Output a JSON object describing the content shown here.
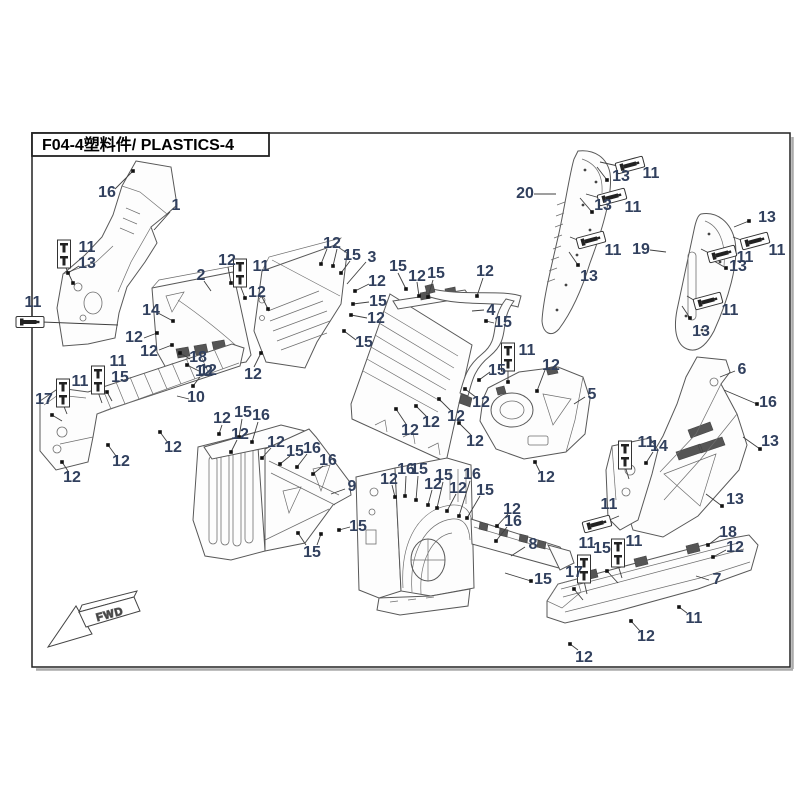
{
  "title": "F04-4塑料件/ PLASTICS-4",
  "fwd_label": "FWD",
  "colors": {
    "label": "#31405e",
    "leader": "#3f3f3f",
    "frame": "#1f1f1f"
  },
  "callouts": [
    {
      "t": "16",
      "x": 107,
      "y": 192
    },
    {
      "t": "1",
      "x": 176,
      "y": 205
    },
    {
      "t": "11",
      "x": 87,
      "y": 247
    },
    {
      "t": "13",
      "x": 87,
      "y": 263
    },
    {
      "t": "11",
      "x": 33,
      "y": 302
    },
    {
      "t": "14",
      "x": 151,
      "y": 310
    },
    {
      "t": "2",
      "x": 201,
      "y": 275
    },
    {
      "t": "12",
      "x": 227,
      "y": 260
    },
    {
      "t": "11",
      "x": 261,
      "y": 266
    },
    {
      "t": "12",
      "x": 134,
      "y": 337
    },
    {
      "t": "12",
      "x": 149,
      "y": 351
    },
    {
      "t": "18",
      "x": 198,
      "y": 357
    },
    {
      "t": "12",
      "x": 208,
      "y": 370
    },
    {
      "t": "12",
      "x": 253,
      "y": 374
    },
    {
      "t": "12",
      "x": 257,
      "y": 292
    },
    {
      "t": "12",
      "x": 332,
      "y": 243
    },
    {
      "t": "15",
      "x": 352,
      "y": 255
    },
    {
      "t": "3",
      "x": 372,
      "y": 257
    },
    {
      "t": "12",
      "x": 377,
      "y": 281
    },
    {
      "t": "15",
      "x": 378,
      "y": 301
    },
    {
      "t": "12",
      "x": 376,
      "y": 318
    },
    {
      "t": "15",
      "x": 364,
      "y": 342
    },
    {
      "t": "15",
      "x": 398,
      "y": 266
    },
    {
      "t": "12",
      "x": 417,
      "y": 276
    },
    {
      "t": "15",
      "x": 436,
      "y": 273
    },
    {
      "t": "12",
      "x": 485,
      "y": 271
    },
    {
      "t": "4",
      "x": 491,
      "y": 310
    },
    {
      "t": "15",
      "x": 503,
      "y": 322
    },
    {
      "t": "11",
      "x": 527,
      "y": 350
    },
    {
      "t": "15",
      "x": 497,
      "y": 370
    },
    {
      "t": "12",
      "x": 551,
      "y": 365
    },
    {
      "t": "12",
      "x": 410,
      "y": 430
    },
    {
      "t": "12",
      "x": 431,
      "y": 422
    },
    {
      "t": "12",
      "x": 456,
      "y": 416
    },
    {
      "t": "12",
      "x": 481,
      "y": 402
    },
    {
      "t": "12",
      "x": 475,
      "y": 441
    },
    {
      "t": "5",
      "x": 592,
      "y": 394
    },
    {
      "t": "12",
      "x": 546,
      "y": 477
    },
    {
      "t": "6",
      "x": 742,
      "y": 369
    },
    {
      "t": "16",
      "x": 768,
      "y": 402
    },
    {
      "t": "13",
      "x": 770,
      "y": 441
    },
    {
      "t": "13",
      "x": 735,
      "y": 499
    },
    {
      "t": "11",
      "x": 646,
      "y": 442
    },
    {
      "t": "14",
      "x": 659,
      "y": 446
    },
    {
      "t": "11",
      "x": 609,
      "y": 504
    },
    {
      "t": "18",
      "x": 728,
      "y": 532
    },
    {
      "t": "12",
      "x": 735,
      "y": 547
    },
    {
      "t": "11",
      "x": 587,
      "y": 543
    },
    {
      "t": "15",
      "x": 602,
      "y": 548
    },
    {
      "t": "11",
      "x": 634,
      "y": 541
    },
    {
      "t": "17",
      "x": 574,
      "y": 572
    },
    {
      "t": "15",
      "x": 543,
      "y": 579
    },
    {
      "t": "7",
      "x": 717,
      "y": 579
    },
    {
      "t": "11",
      "x": 694,
      "y": 618
    },
    {
      "t": "12",
      "x": 646,
      "y": 636
    },
    {
      "t": "12",
      "x": 584,
      "y": 657
    },
    {
      "t": "12",
      "x": 389,
      "y": 479
    },
    {
      "t": "16",
      "x": 406,
      "y": 469
    },
    {
      "t": "15",
      "x": 419,
      "y": 469
    },
    {
      "t": "12",
      "x": 433,
      "y": 484
    },
    {
      "t": "15",
      "x": 444,
      "y": 475
    },
    {
      "t": "12",
      "x": 458,
      "y": 488
    },
    {
      "t": "16",
      "x": 472,
      "y": 474
    },
    {
      "t": "15",
      "x": 485,
      "y": 490
    },
    {
      "t": "12",
      "x": 512,
      "y": 509
    },
    {
      "t": "16",
      "x": 513,
      "y": 521
    },
    {
      "t": "8",
      "x": 533,
      "y": 544
    },
    {
      "t": "12",
      "x": 222,
      "y": 418
    },
    {
      "t": "15",
      "x": 243,
      "y": 412
    },
    {
      "t": "16",
      "x": 261,
      "y": 415
    },
    {
      "t": "12",
      "x": 240,
      "y": 434
    },
    {
      "t": "12",
      "x": 276,
      "y": 442
    },
    {
      "t": "15",
      "x": 295,
      "y": 451
    },
    {
      "t": "16",
      "x": 312,
      "y": 448
    },
    {
      "t": "16",
      "x": 328,
      "y": 460
    },
    {
      "t": "9",
      "x": 352,
      "y": 486
    },
    {
      "t": "15",
      "x": 358,
      "y": 526
    },
    {
      "t": "15",
      "x": 312,
      "y": 552
    },
    {
      "t": "17",
      "x": 44,
      "y": 399
    },
    {
      "t": "11",
      "x": 80,
      "y": 381
    },
    {
      "t": "11",
      "x": 118,
      "y": 361
    },
    {
      "t": "15",
      "x": 120,
      "y": 377
    },
    {
      "t": "10",
      "x": 196,
      "y": 397
    },
    {
      "t": "12",
      "x": 204,
      "y": 371
    },
    {
      "t": "12",
      "x": 173,
      "y": 447
    },
    {
      "t": "12",
      "x": 121,
      "y": 461
    },
    {
      "t": "12",
      "x": 72,
      "y": 477
    },
    {
      "t": "20",
      "x": 525,
      "y": 193
    },
    {
      "t": "13",
      "x": 621,
      "y": 176
    },
    {
      "t": "11",
      "x": 651,
      "y": 173
    },
    {
      "t": "13",
      "x": 603,
      "y": 205
    },
    {
      "t": "11",
      "x": 633,
      "y": 207
    },
    {
      "t": "11",
      "x": 613,
      "y": 250
    },
    {
      "t": "13",
      "x": 589,
      "y": 276
    },
    {
      "t": "19",
      "x": 641,
      "y": 249
    },
    {
      "t": "13",
      "x": 767,
      "y": 217
    },
    {
      "t": "11",
      "x": 777,
      "y": 250
    },
    {
      "t": "11",
      "x": 745,
      "y": 257
    },
    {
      "t": "13",
      "x": 738,
      "y": 266
    },
    {
      "t": "11",
      "x": 730,
      "y": 310
    },
    {
      "t": "13",
      "x": 701,
      "y": 331
    }
  ],
  "leaders": [
    {
      "x1": 115,
      "y1": 189,
      "x2": 133,
      "y2": 171,
      "d": 1
    },
    {
      "x1": 170,
      "y1": 212,
      "x2": 154,
      "y2": 230,
      "d": 0
    },
    {
      "x1": 66,
      "y1": 268,
      "x2": 73,
      "y2": 283,
      "d": 1
    },
    {
      "x1": 79,
      "y1": 266,
      "x2": 68,
      "y2": 273,
      "d": 1
    },
    {
      "x1": 42,
      "y1": 322,
      "x2": 118,
      "y2": 325,
      "d": 0
    },
    {
      "x1": 158,
      "y1": 313,
      "x2": 173,
      "y2": 321,
      "d": 1
    },
    {
      "x1": 204,
      "y1": 281,
      "x2": 211,
      "y2": 291,
      "d": 0
    },
    {
      "x1": 228,
      "y1": 267,
      "x2": 231,
      "y2": 283,
      "d": 1
    },
    {
      "x1": 240,
      "y1": 285,
      "x2": 245,
      "y2": 298,
      "d": 1
    },
    {
      "x1": 144,
      "y1": 338,
      "x2": 157,
      "y2": 333,
      "d": 1
    },
    {
      "x1": 159,
      "y1": 350,
      "x2": 172,
      "y2": 345,
      "d": 1
    },
    {
      "x1": 190,
      "y1": 359,
      "x2": 180,
      "y2": 353,
      "d": 1
    },
    {
      "x1": 199,
      "y1": 371,
      "x2": 187,
      "y2": 365,
      "d": 1
    },
    {
      "x1": 254,
      "y1": 367,
      "x2": 261,
      "y2": 353,
      "d": 1
    },
    {
      "x1": 262,
      "y1": 297,
      "x2": 268,
      "y2": 309,
      "d": 1
    },
    {
      "x1": 327,
      "y1": 249,
      "x2": 321,
      "y2": 264,
      "d": 1
    },
    {
      "x1": 337,
      "y1": 249,
      "x2": 333,
      "y2": 266,
      "d": 1
    },
    {
      "x1": 350,
      "y1": 261,
      "x2": 341,
      "y2": 273,
      "d": 1
    },
    {
      "x1": 366,
      "y1": 262,
      "x2": 347,
      "y2": 284,
      "d": 0
    },
    {
      "x1": 369,
      "y1": 284,
      "x2": 355,
      "y2": 291,
      "d": 1
    },
    {
      "x1": 369,
      "y1": 302,
      "x2": 353,
      "y2": 304,
      "d": 1
    },
    {
      "x1": 367,
      "y1": 318,
      "x2": 351,
      "y2": 315,
      "d": 1
    },
    {
      "x1": 356,
      "y1": 340,
      "x2": 344,
      "y2": 331,
      "d": 1
    },
    {
      "x1": 398,
      "y1": 273,
      "x2": 406,
      "y2": 289,
      "d": 1
    },
    {
      "x1": 417,
      "y1": 282,
      "x2": 419,
      "y2": 296,
      "d": 1
    },
    {
      "x1": 433,
      "y1": 280,
      "x2": 428,
      "y2": 297,
      "d": 1
    },
    {
      "x1": 483,
      "y1": 278,
      "x2": 477,
      "y2": 296,
      "d": 1
    },
    {
      "x1": 484,
      "y1": 310,
      "x2": 472,
      "y2": 311,
      "d": 0
    },
    {
      "x1": 494,
      "y1": 323,
      "x2": 486,
      "y2": 321,
      "d": 1
    },
    {
      "x1": 508,
      "y1": 366,
      "x2": 508,
      "y2": 382,
      "d": 1
    },
    {
      "x1": 490,
      "y1": 372,
      "x2": 479,
      "y2": 380,
      "d": 1
    },
    {
      "x1": 545,
      "y1": 370,
      "x2": 537,
      "y2": 391,
      "d": 1
    },
    {
      "x1": 406,
      "y1": 424,
      "x2": 396,
      "y2": 409,
      "d": 1
    },
    {
      "x1": 427,
      "y1": 417,
      "x2": 416,
      "y2": 406,
      "d": 1
    },
    {
      "x1": 451,
      "y1": 411,
      "x2": 439,
      "y2": 399,
      "d": 1
    },
    {
      "x1": 477,
      "y1": 398,
      "x2": 465,
      "y2": 389,
      "d": 1
    },
    {
      "x1": 471,
      "y1": 435,
      "x2": 459,
      "y2": 423,
      "d": 1
    },
    {
      "x1": 585,
      "y1": 397,
      "x2": 574,
      "y2": 404,
      "d": 0
    },
    {
      "x1": 540,
      "y1": 472,
      "x2": 535,
      "y2": 462,
      "d": 1
    },
    {
      "x1": 735,
      "y1": 371,
      "x2": 720,
      "y2": 377,
      "d": 0
    },
    {
      "x1": 724,
      "y1": 390,
      "x2": 757,
      "y2": 404,
      "d": 1
    },
    {
      "x1": 743,
      "y1": 437,
      "x2": 760,
      "y2": 449,
      "d": 1
    },
    {
      "x1": 706,
      "y1": 494,
      "x2": 722,
      "y2": 506,
      "d": 1
    },
    {
      "x1": 625,
      "y1": 466,
      "x2": 629,
      "y2": 479,
      "d": 0
    },
    {
      "x1": 653,
      "y1": 452,
      "x2": 646,
      "y2": 463,
      "d": 1
    },
    {
      "x1": 607,
      "y1": 521,
      "x2": 619,
      "y2": 516,
      "d": 0
    },
    {
      "x1": 720,
      "y1": 536,
      "x2": 708,
      "y2": 545,
      "d": 1
    },
    {
      "x1": 726,
      "y1": 550,
      "x2": 713,
      "y2": 557,
      "d": 1
    },
    {
      "x1": 584,
      "y1": 581,
      "x2": 587,
      "y2": 594,
      "d": 0
    },
    {
      "x1": 618,
      "y1": 583,
      "x2": 607,
      "y2": 571,
      "d": 1
    },
    {
      "x1": 618,
      "y1": 565,
      "x2": 622,
      "y2": 578,
      "d": 0
    },
    {
      "x1": 583,
      "y1": 600,
      "x2": 574,
      "y2": 589,
      "d": 1
    },
    {
      "x1": 505,
      "y1": 573,
      "x2": 531,
      "y2": 581,
      "d": 1
    },
    {
      "x1": 709,
      "y1": 580,
      "x2": 696,
      "y2": 576,
      "d": 0
    },
    {
      "x1": 687,
      "y1": 613,
      "x2": 679,
      "y2": 607,
      "d": 1
    },
    {
      "x1": 640,
      "y1": 631,
      "x2": 631,
      "y2": 621,
      "d": 1
    },
    {
      "x1": 578,
      "y1": 650,
      "x2": 570,
      "y2": 644,
      "d": 1
    },
    {
      "x1": 392,
      "y1": 485,
      "x2": 395,
      "y2": 497,
      "d": 1
    },
    {
      "x1": 406,
      "y1": 476,
      "x2": 405,
      "y2": 496,
      "d": 1
    },
    {
      "x1": 418,
      "y1": 476,
      "x2": 416,
      "y2": 500,
      "d": 1
    },
    {
      "x1": 432,
      "y1": 490,
      "x2": 428,
      "y2": 505,
      "d": 1
    },
    {
      "x1": 443,
      "y1": 482,
      "x2": 437,
      "y2": 508,
      "d": 1
    },
    {
      "x1": 456,
      "y1": 494,
      "x2": 447,
      "y2": 511,
      "d": 1
    },
    {
      "x1": 470,
      "y1": 481,
      "x2": 459,
      "y2": 516,
      "d": 1
    },
    {
      "x1": 480,
      "y1": 496,
      "x2": 467,
      "y2": 518,
      "d": 1
    },
    {
      "x1": 508,
      "y1": 514,
      "x2": 497,
      "y2": 526,
      "d": 1
    },
    {
      "x1": 507,
      "y1": 527,
      "x2": 496,
      "y2": 541,
      "d": 1
    },
    {
      "x1": 525,
      "y1": 547,
      "x2": 511,
      "y2": 556,
      "d": 0
    },
    {
      "x1": 222,
      "y1": 425,
      "x2": 219,
      "y2": 434,
      "d": 1
    },
    {
      "x1": 242,
      "y1": 419,
      "x2": 239,
      "y2": 437,
      "d": 1
    },
    {
      "x1": 258,
      "y1": 422,
      "x2": 252,
      "y2": 442,
      "d": 1
    },
    {
      "x1": 237,
      "y1": 440,
      "x2": 231,
      "y2": 452,
      "d": 1
    },
    {
      "x1": 271,
      "y1": 448,
      "x2": 262,
      "y2": 458,
      "d": 1
    },
    {
      "x1": 290,
      "y1": 456,
      "x2": 280,
      "y2": 464,
      "d": 1
    },
    {
      "x1": 307,
      "y1": 454,
      "x2": 297,
      "y2": 467,
      "d": 1
    },
    {
      "x1": 323,
      "y1": 466,
      "x2": 313,
      "y2": 474,
      "d": 1
    },
    {
      "x1": 345,
      "y1": 489,
      "x2": 331,
      "y2": 494,
      "d": 0
    },
    {
      "x1": 350,
      "y1": 527,
      "x2": 339,
      "y2": 530,
      "d": 1
    },
    {
      "x1": 306,
      "y1": 545,
      "x2": 298,
      "y2": 533,
      "d": 1
    },
    {
      "x1": 317,
      "y1": 545,
      "x2": 321,
      "y2": 534,
      "d": 1
    },
    {
      "x1": 62,
      "y1": 421,
      "x2": 52,
      "y2": 415,
      "d": 1
    },
    {
      "x1": 63,
      "y1": 404,
      "x2": 67,
      "y2": 414,
      "d": 0
    },
    {
      "x1": 98,
      "y1": 392,
      "x2": 102,
      "y2": 403,
      "d": 0
    },
    {
      "x1": 112,
      "y1": 401,
      "x2": 107,
      "y2": 392,
      "d": 1
    },
    {
      "x1": 189,
      "y1": 399,
      "x2": 177,
      "y2": 396,
      "d": 0
    },
    {
      "x1": 200,
      "y1": 377,
      "x2": 193,
      "y2": 386,
      "d": 1
    },
    {
      "x1": 168,
      "y1": 443,
      "x2": 160,
      "y2": 432,
      "d": 1
    },
    {
      "x1": 116,
      "y1": 456,
      "x2": 108,
      "y2": 445,
      "d": 1
    },
    {
      "x1": 68,
      "y1": 471,
      "x2": 62,
      "y2": 462,
      "d": 1
    },
    {
      "x1": 534,
      "y1": 194,
      "x2": 556,
      "y2": 194,
      "d": 0
    },
    {
      "x1": 597,
      "y1": 167,
      "x2": 607,
      "y2": 180,
      "d": 1
    },
    {
      "x1": 618,
      "y1": 166,
      "x2": 600,
      "y2": 162,
      "d": 0
    },
    {
      "x1": 580,
      "y1": 198,
      "x2": 592,
      "y2": 212,
      "d": 1
    },
    {
      "x1": 600,
      "y1": 198,
      "x2": 586,
      "y2": 194,
      "d": 0
    },
    {
      "x1": 580,
      "y1": 241,
      "x2": 570,
      "y2": 237,
      "d": 0
    },
    {
      "x1": 569,
      "y1": 252,
      "x2": 578,
      "y2": 265,
      "d": 1
    },
    {
      "x1": 650,
      "y1": 250,
      "x2": 666,
      "y2": 252,
      "d": 0
    },
    {
      "x1": 734,
      "y1": 227,
      "x2": 749,
      "y2": 221,
      "d": 1
    },
    {
      "x1": 744,
      "y1": 241,
      "x2": 733,
      "y2": 237,
      "d": 0
    },
    {
      "x1": 711,
      "y1": 254,
      "x2": 701,
      "y2": 249,
      "d": 0
    },
    {
      "x1": 714,
      "y1": 261,
      "x2": 726,
      "y2": 268,
      "d": 1
    },
    {
      "x1": 697,
      "y1": 302,
      "x2": 687,
      "y2": 296,
      "d": 0
    },
    {
      "x1": 682,
      "y1": 306,
      "x2": 690,
      "y2": 318,
      "d": 1
    }
  ],
  "fasteners": [
    {
      "k": "v",
      "x": 64,
      "y": 254,
      "r": 0
    },
    {
      "k": "v",
      "x": 240,
      "y": 273,
      "r": 0
    },
    {
      "k": "v",
      "x": 98,
      "y": 380,
      "r": 0
    },
    {
      "k": "v",
      "x": 63,
      "y": 393,
      "r": 0
    },
    {
      "k": "v",
      "x": 508,
      "y": 357,
      "r": 0
    },
    {
      "k": "v",
      "x": 584,
      "y": 569,
      "r": 0
    },
    {
      "k": "v",
      "x": 618,
      "y": 553,
      "r": 0
    },
    {
      "k": "v",
      "x": 625,
      "y": 455,
      "r": 0
    },
    {
      "k": "h",
      "x": 30,
      "y": 322,
      "r": 0
    },
    {
      "k": "h",
      "x": 630,
      "y": 165,
      "r": -15
    },
    {
      "k": "h",
      "x": 612,
      "y": 197,
      "r": -15
    },
    {
      "k": "h",
      "x": 591,
      "y": 240,
      "r": -15
    },
    {
      "k": "h",
      "x": 755,
      "y": 241,
      "r": -15
    },
    {
      "k": "h",
      "x": 722,
      "y": 254,
      "r": -15
    },
    {
      "k": "h",
      "x": 708,
      "y": 301,
      "r": -15
    },
    {
      "k": "h",
      "x": 597,
      "y": 524,
      "r": -15
    }
  ]
}
